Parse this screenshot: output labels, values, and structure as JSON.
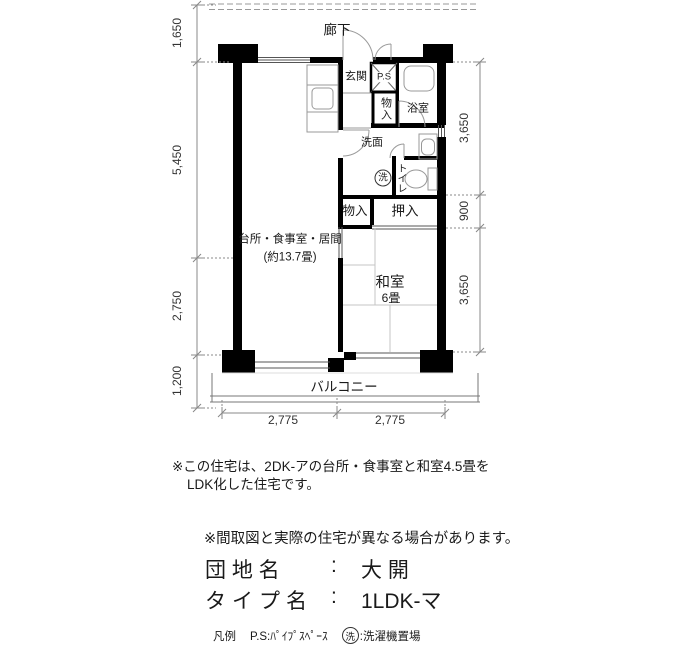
{
  "plan": {
    "corridor": "廊下",
    "rooms": {
      "genkan": "玄関",
      "ps": "P.S",
      "closet_hall": "物入",
      "bathroom": "浴室",
      "washroom": "洗面",
      "toilet": "トイレ",
      "laundry": "洗",
      "closet": "物入",
      "oshiire": "押入",
      "ldk_name": "台所・食事室・居間",
      "ldk_size": "(約13.7畳)",
      "washitsu": "和室",
      "washitsu_size": "6畳",
      "balcony": "バルコニー"
    },
    "dimensions": {
      "left": [
        "1,650",
        "5,450",
        "2,750",
        "1,200"
      ],
      "right": [
        "3,650",
        "900",
        "3,650"
      ],
      "bottom": [
        "2,775",
        "2,775"
      ]
    }
  },
  "notes": {
    "remodel_1": "※この住宅は、2DK-アの台所・食事室と和室4.5畳を",
    "remodel_2": "LDK化した住宅です。",
    "disclaimer": "※間取図と実際の住宅が異なる場合があります。"
  },
  "estate": {
    "label": "団 地 名",
    "colon": ":",
    "value": "大 開"
  },
  "type": {
    "label": "タイプ名",
    "colon": ":",
    "value": "1LDK-マ"
  },
  "legend": {
    "heading": "凡例",
    "ps_item": "P.S:ﾊﾟｲﾌﾟｽﾍﾟｰｽ",
    "laundry_mark": "洗",
    "laundry_desc": ":洗濯機置場"
  },
  "colors": {
    "wall": "#000000",
    "thin_line": "#888888",
    "fixture": "#999999"
  }
}
